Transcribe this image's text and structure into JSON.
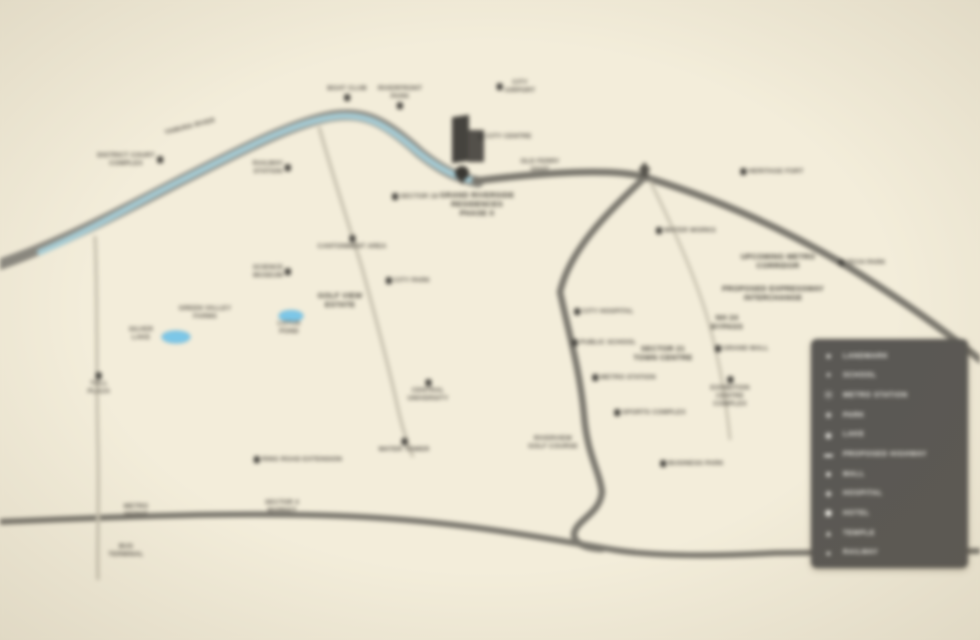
{
  "map": {
    "title": "project location map",
    "river_label": "YAMUNA RIVER",
    "colors": {
      "background": "#f3edda",
      "road": "#7a776e",
      "minor_road": "#c8c2b0",
      "river": "#a7cdd6",
      "river_casing": "#8a8880",
      "lake": "#7cc7e8",
      "label_text": "#55514a",
      "legend_bg": "#5a5854",
      "legend_text": "#f1efe8",
      "landmark_building": "#45433e"
    },
    "places": [
      {
        "x": 130,
        "y": 160,
        "text": "DISTRICT COURT\nCOMPLEX",
        "icon": "right"
      },
      {
        "x": 272,
        "y": 168,
        "text": "RAILWAY\nSTATION",
        "icon": "right"
      },
      {
        "x": 347,
        "y": 93,
        "text": "BOAT CLUB",
        "icon": "below"
      },
      {
        "x": 400,
        "y": 97,
        "text": "RIVERFRONT\nPARK",
        "icon": "below"
      },
      {
        "x": 516,
        "y": 87,
        "text": "CITY\nAIRPORT",
        "icon": "left"
      },
      {
        "x": 505,
        "y": 137,
        "text": "CITY CENTRE",
        "icon": "left"
      },
      {
        "x": 540,
        "y": 166,
        "text": "OLD FERRY\nGHAT",
        "icon": "none"
      },
      {
        "x": 477,
        "y": 204,
        "text": "GRAND RIVERSIDE\nRESIDENCES\nPHASE II",
        "icon": "none",
        "bold": true
      },
      {
        "x": 415,
        "y": 197,
        "text": "SECTOR 18",
        "icon": "left"
      },
      {
        "x": 352,
        "y": 243,
        "text": "CANTONMENT AREA",
        "icon": "above"
      },
      {
        "x": 272,
        "y": 272,
        "text": "SCIENCE\nMUSEUM",
        "icon": "right"
      },
      {
        "x": 408,
        "y": 281,
        "text": "CITY PARK",
        "icon": "left"
      },
      {
        "x": 340,
        "y": 300,
        "text": "GOLF VIEW\nESTATE",
        "icon": "none",
        "bold": true
      },
      {
        "x": 205,
        "y": 313,
        "text": "GREEN VALLEY\nFARMS",
        "icon": "none"
      },
      {
        "x": 141,
        "y": 334,
        "text": "SILVER\nLAKE",
        "icon": "none"
      },
      {
        "x": 289,
        "y": 328,
        "text": "LOTUS\nPOND",
        "icon": "none"
      },
      {
        "x": 99,
        "y": 384,
        "text": "TOLL\nPLAZA",
        "icon": "above"
      },
      {
        "x": 428,
        "y": 391,
        "text": "CENTRAL\nUNIVERSITY",
        "icon": "above"
      },
      {
        "x": 404,
        "y": 446,
        "text": "WATER TOWER",
        "icon": "above"
      },
      {
        "x": 298,
        "y": 460,
        "text": "RING ROAD EXTENSION",
        "icon": "left"
      },
      {
        "x": 282,
        "y": 507,
        "text": "SECTOR 4\nMARKET",
        "icon": "none"
      },
      {
        "x": 136,
        "y": 511,
        "text": "METRO\nDEPOT",
        "icon": "none"
      },
      {
        "x": 126,
        "y": 551,
        "text": "BUS\nTERMINAL",
        "icon": "none"
      },
      {
        "x": 553,
        "y": 443,
        "text": "RIVERVIEW\nGOLF COURSE",
        "icon": "none"
      },
      {
        "x": 650,
        "y": 413,
        "text": "SPORTS COMPLEX",
        "icon": "left"
      },
      {
        "x": 692,
        "y": 464,
        "text": "BUSINESS PARK",
        "icon": "left"
      },
      {
        "x": 604,
        "y": 312,
        "text": "CITY HOSPITAL",
        "icon": "left"
      },
      {
        "x": 604,
        "y": 343,
        "text": "PUBLIC SCHOOL",
        "icon": "left"
      },
      {
        "x": 663,
        "y": 353,
        "text": "SECTOR 21\nTOWN CENTRE",
        "icon": "none",
        "bold": true
      },
      {
        "x": 624,
        "y": 378,
        "text": "METRO STATION",
        "icon": "left"
      },
      {
        "x": 686,
        "y": 231,
        "text": "WATER WORKS",
        "icon": "left"
      },
      {
        "x": 772,
        "y": 172,
        "text": "HERITAGE FORT",
        "icon": "left"
      },
      {
        "x": 862,
        "y": 263,
        "text": "TECH PARK",
        "icon": "left"
      },
      {
        "x": 778,
        "y": 261,
        "text": "UPCOMING METRO\nCORRIDOR",
        "icon": "none",
        "bold": true
      },
      {
        "x": 773,
        "y": 293,
        "text": "PROPOSED EXPRESSWAY\nINTERCHANGE",
        "icon": "none",
        "bold": true
      },
      {
        "x": 727,
        "y": 322,
        "text": "NH 24\nBYPASS",
        "icon": "none",
        "bold": true
      },
      {
        "x": 742,
        "y": 349,
        "text": "GRAND MALL",
        "icon": "left"
      },
      {
        "x": 730,
        "y": 392,
        "text": "EXHIBITION\nCENTRE\nCOMPLEX",
        "icon": "above"
      }
    ],
    "legend": {
      "items": [
        {
          "icon": "★",
          "label": "LANDMARK"
        },
        {
          "icon": "✦",
          "label": "SCHOOL"
        },
        {
          "icon": "Ⓜ",
          "label": "METRO STATION"
        },
        {
          "icon": "❀",
          "label": "PARK"
        },
        {
          "icon": "◉",
          "label": "LAKE"
        },
        {
          "icon": "▬",
          "label": "PROPOSED HIGHWAY"
        },
        {
          "icon": "■",
          "label": "MALL"
        },
        {
          "icon": "✚",
          "label": "HOSPITAL"
        },
        {
          "icon": "⬟",
          "label": "HOTEL"
        },
        {
          "icon": "▲",
          "label": "TEMPLE"
        },
        {
          "icon": "●",
          "label": "RAILWAY"
        }
      ]
    }
  }
}
